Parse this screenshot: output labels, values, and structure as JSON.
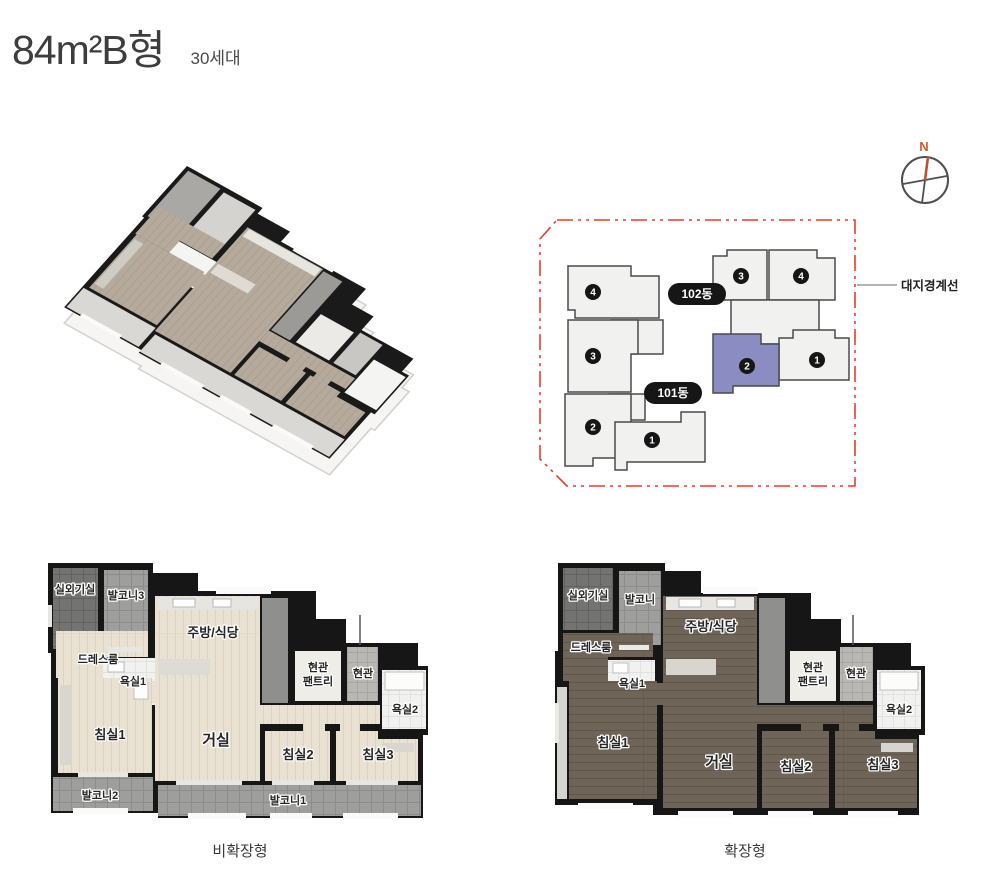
{
  "header": {
    "title": "84m²B형",
    "units_count": "30세대"
  },
  "site_plan": {
    "compass_n": "N",
    "boundary_label": "대지경계선",
    "badge_101": "101동",
    "badge_102": "102동",
    "units_101": [
      "1",
      "2",
      "3",
      "4"
    ],
    "units_102": [
      "1",
      "2",
      "3",
      "4"
    ],
    "highlighted_unit": "2",
    "colors": {
      "boundary": "#e63c30",
      "highlight": "#8b8dc2",
      "building_fill": "#f1f1ef",
      "building_stroke": "#4b4b4b",
      "badge_bg": "#161616",
      "compass_orange": "#d75a2b"
    }
  },
  "plan_left": {
    "caption": "비확장형",
    "rooms": {
      "outdoor_unit": "실외기실",
      "balcony3": "발코니3",
      "kitchen_dining": "주방/식당",
      "dress_room": "드레스룸",
      "bath1": "욕실1",
      "pantry_l1": "현관",
      "pantry_l2": "팬트리",
      "entrance": "현관",
      "bath2": "욕실2",
      "bed1": "침실1",
      "living": "거실",
      "bed2": "침실2",
      "bed3": "침실3",
      "balcony2": "발코니2",
      "balcony1": "발코니1"
    }
  },
  "plan_right": {
    "caption": "확장형",
    "rooms": {
      "outdoor_unit": "실외기실",
      "balcony": "발코니",
      "kitchen_dining": "주방/식당",
      "dress_room": "드레스룸",
      "bath1": "욕실1",
      "pantry_l1": "현관",
      "pantry_l2": "팬트리",
      "entrance": "현관",
      "bath2": "욕실2",
      "bed1": "침실1",
      "living": "거실",
      "bed2": "침실2",
      "bed3": "침실3"
    }
  }
}
